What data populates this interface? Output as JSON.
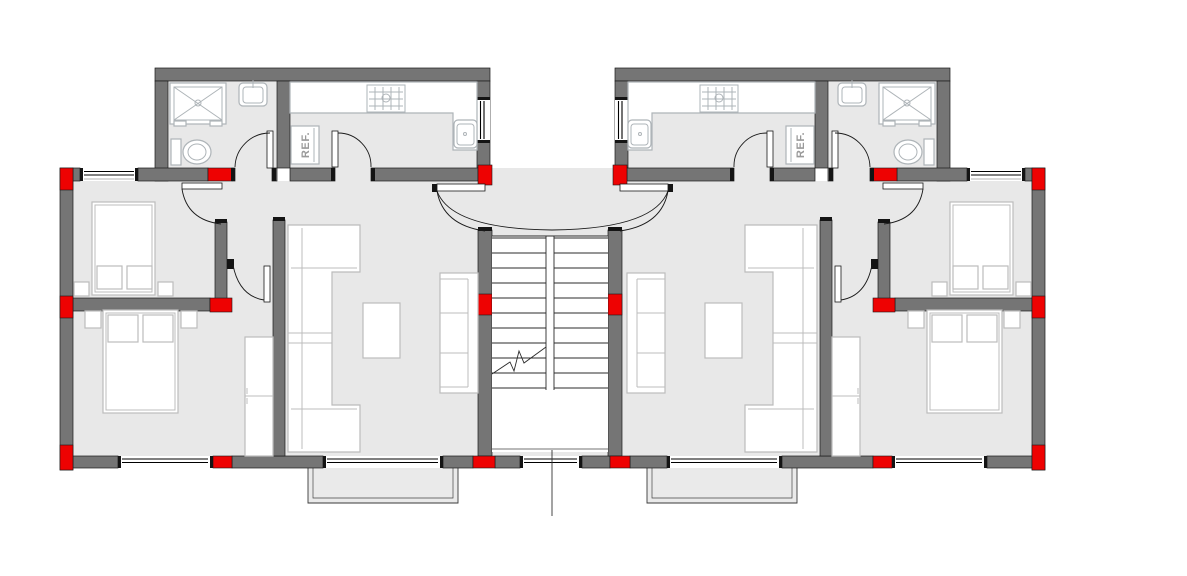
{
  "drawing": {
    "type": "floor-plan",
    "description": "Symmetric two-unit residential floor plan, mirrored apartments around a central double-flight staircase"
  },
  "labels": {
    "fridge_left": "REF.",
    "fridge_right": "REF."
  },
  "colors": {
    "background": "#ffffff",
    "floor": "#e8e8e8",
    "wall": "#757575",
    "outline": "#1a1a1a",
    "column": "#ee0202",
    "fixture": "#aeb4b8",
    "furniture": "#bcbcbc",
    "stair": "#2b2b2b",
    "text": "#9a9a9a"
  },
  "units": {
    "left": {
      "rooms": [
        "bathroom",
        "kitchen",
        "bedroom-top",
        "bedroom-bottom",
        "living-room",
        "hall-corridor"
      ]
    },
    "right": {
      "rooms": [
        "kitchen",
        "bathroom",
        "bedroom-top",
        "bedroom-bottom",
        "living-room",
        "hall-corridor"
      ]
    }
  },
  "staircase": {
    "flights": 2,
    "treads_per_flight": 11
  }
}
